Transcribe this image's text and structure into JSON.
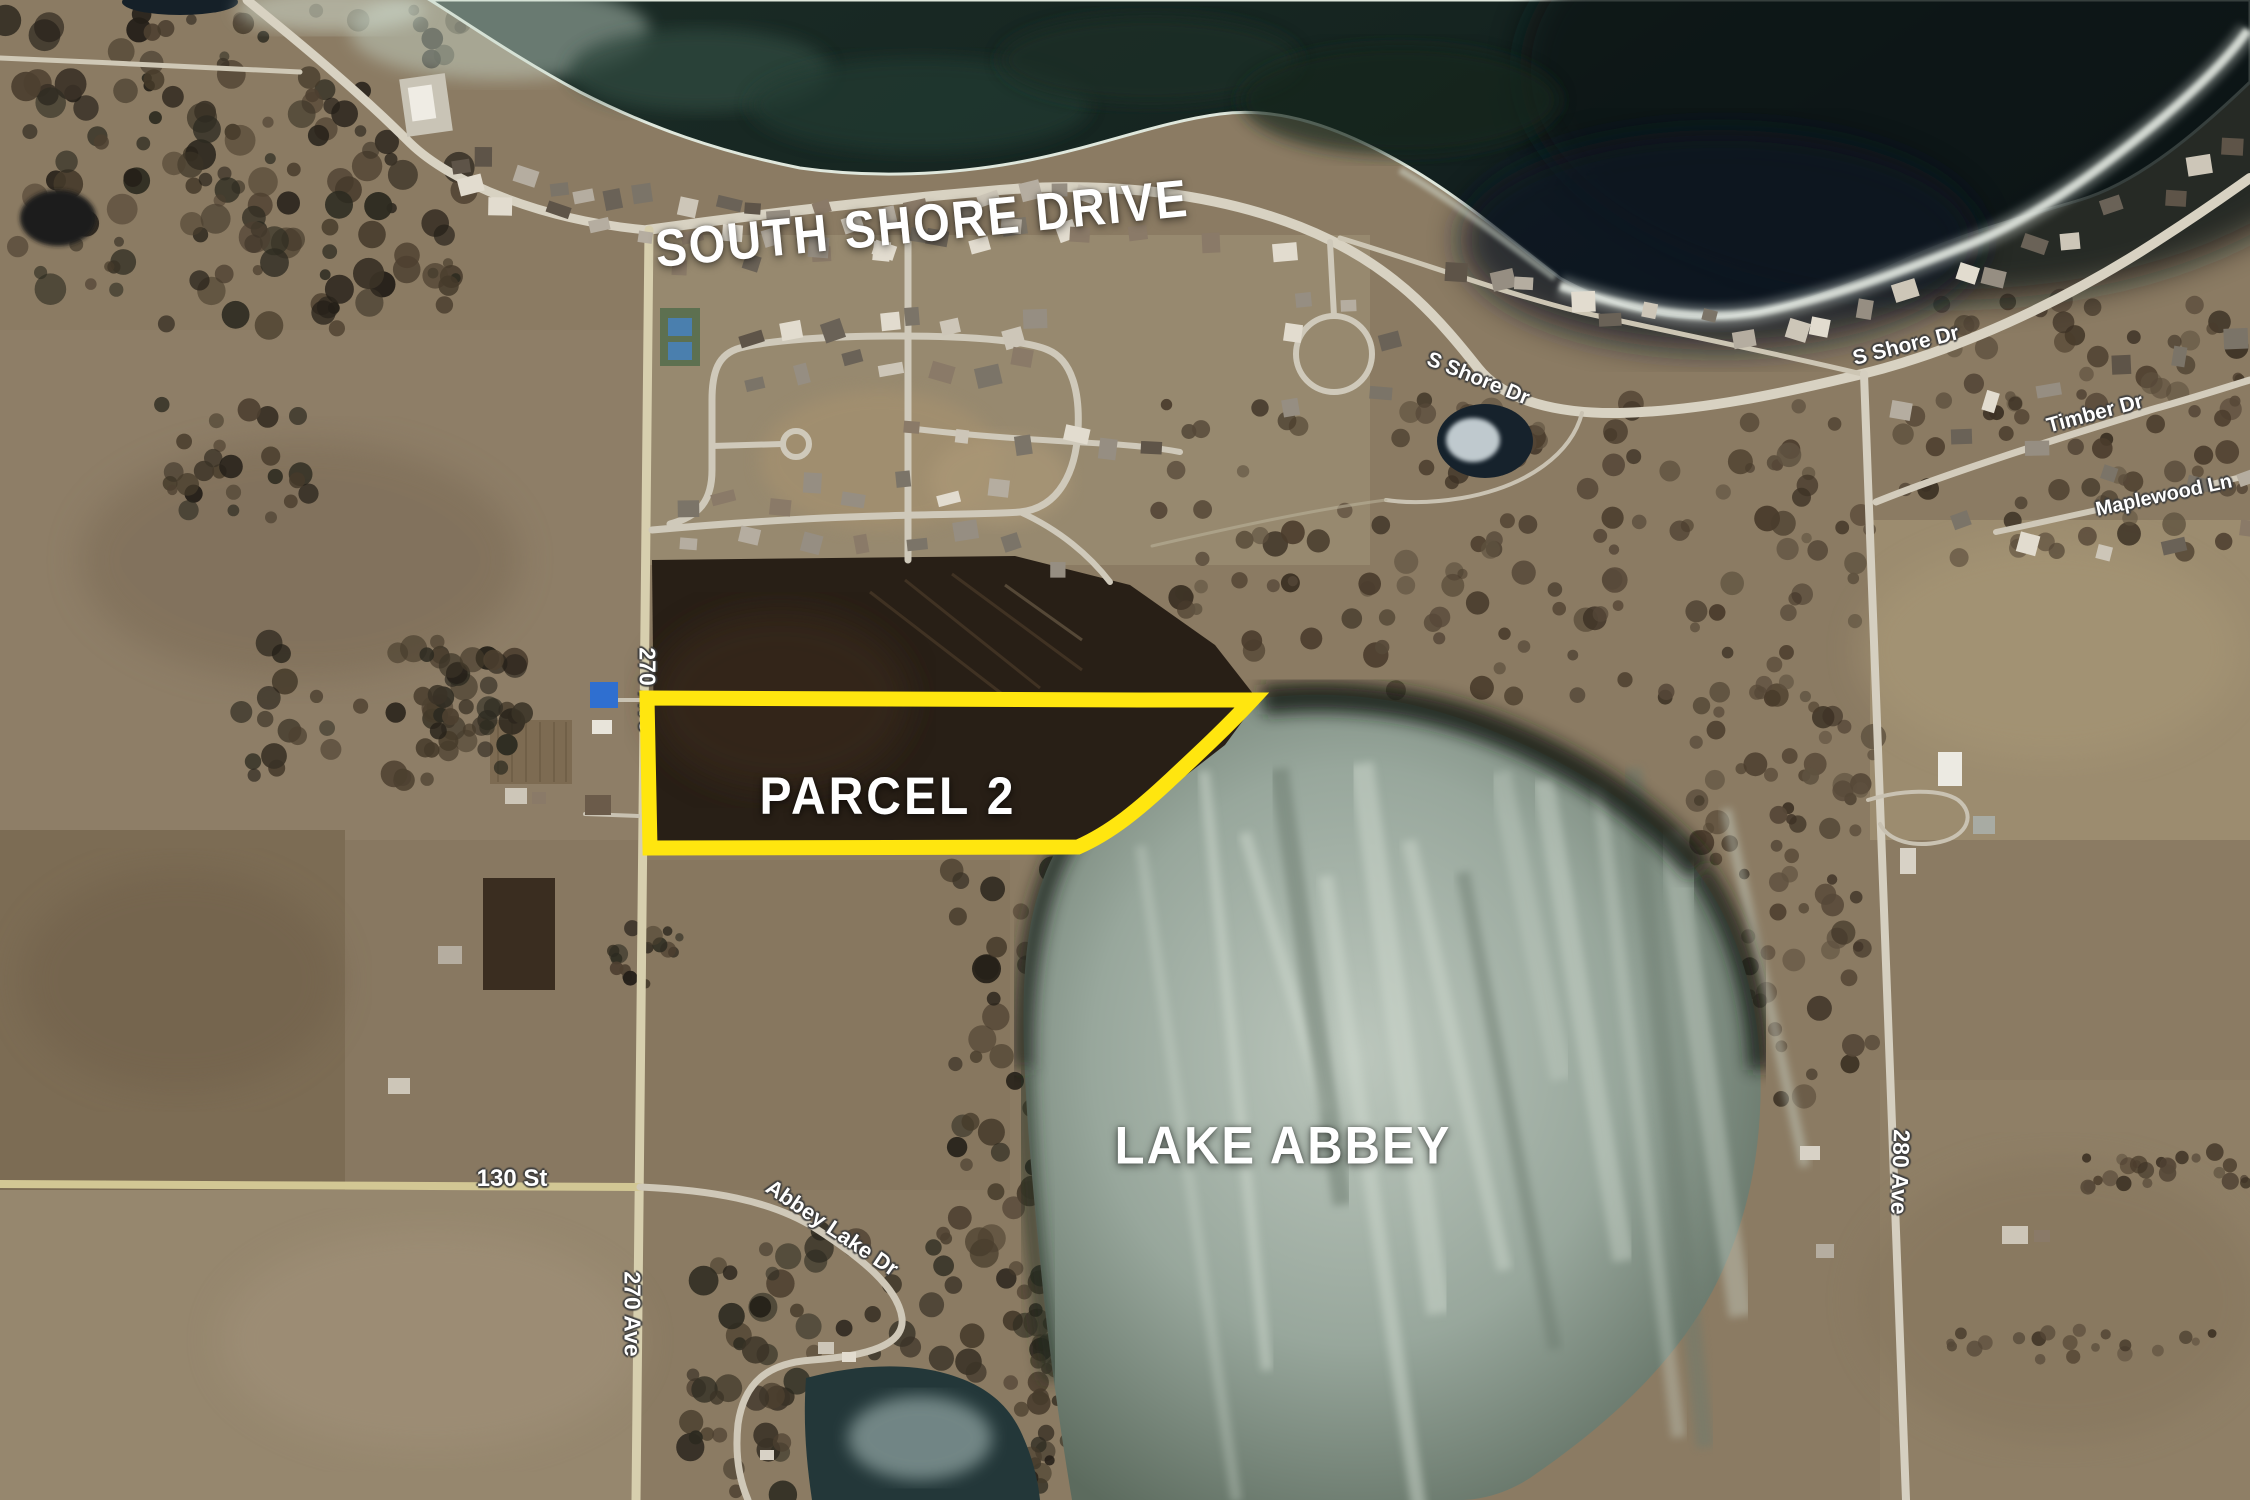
{
  "map": {
    "region_labels": {
      "south_shore_drive": "SOUTH SHORE DRIVE",
      "parcel": "PARCEL 2",
      "lake": "LAKE ABBEY"
    },
    "road_labels": {
      "s_shore_dr_mid": "S Shore Dr",
      "s_shore_dr_right": "S Shore Dr",
      "timber_dr": "Timber Dr",
      "maplewood_ln": "Maplewood Ln",
      "ave_270_upper": "270 Ave",
      "ave_270_lower": "270 Ave",
      "st_130": "130 St",
      "abbey_lake_dr": "Abbey Lake Dr",
      "ave_280": "280 Ave"
    },
    "colors": {
      "parcel_outline": "#FFE60F",
      "label_text": "#FFFFFF"
    }
  }
}
